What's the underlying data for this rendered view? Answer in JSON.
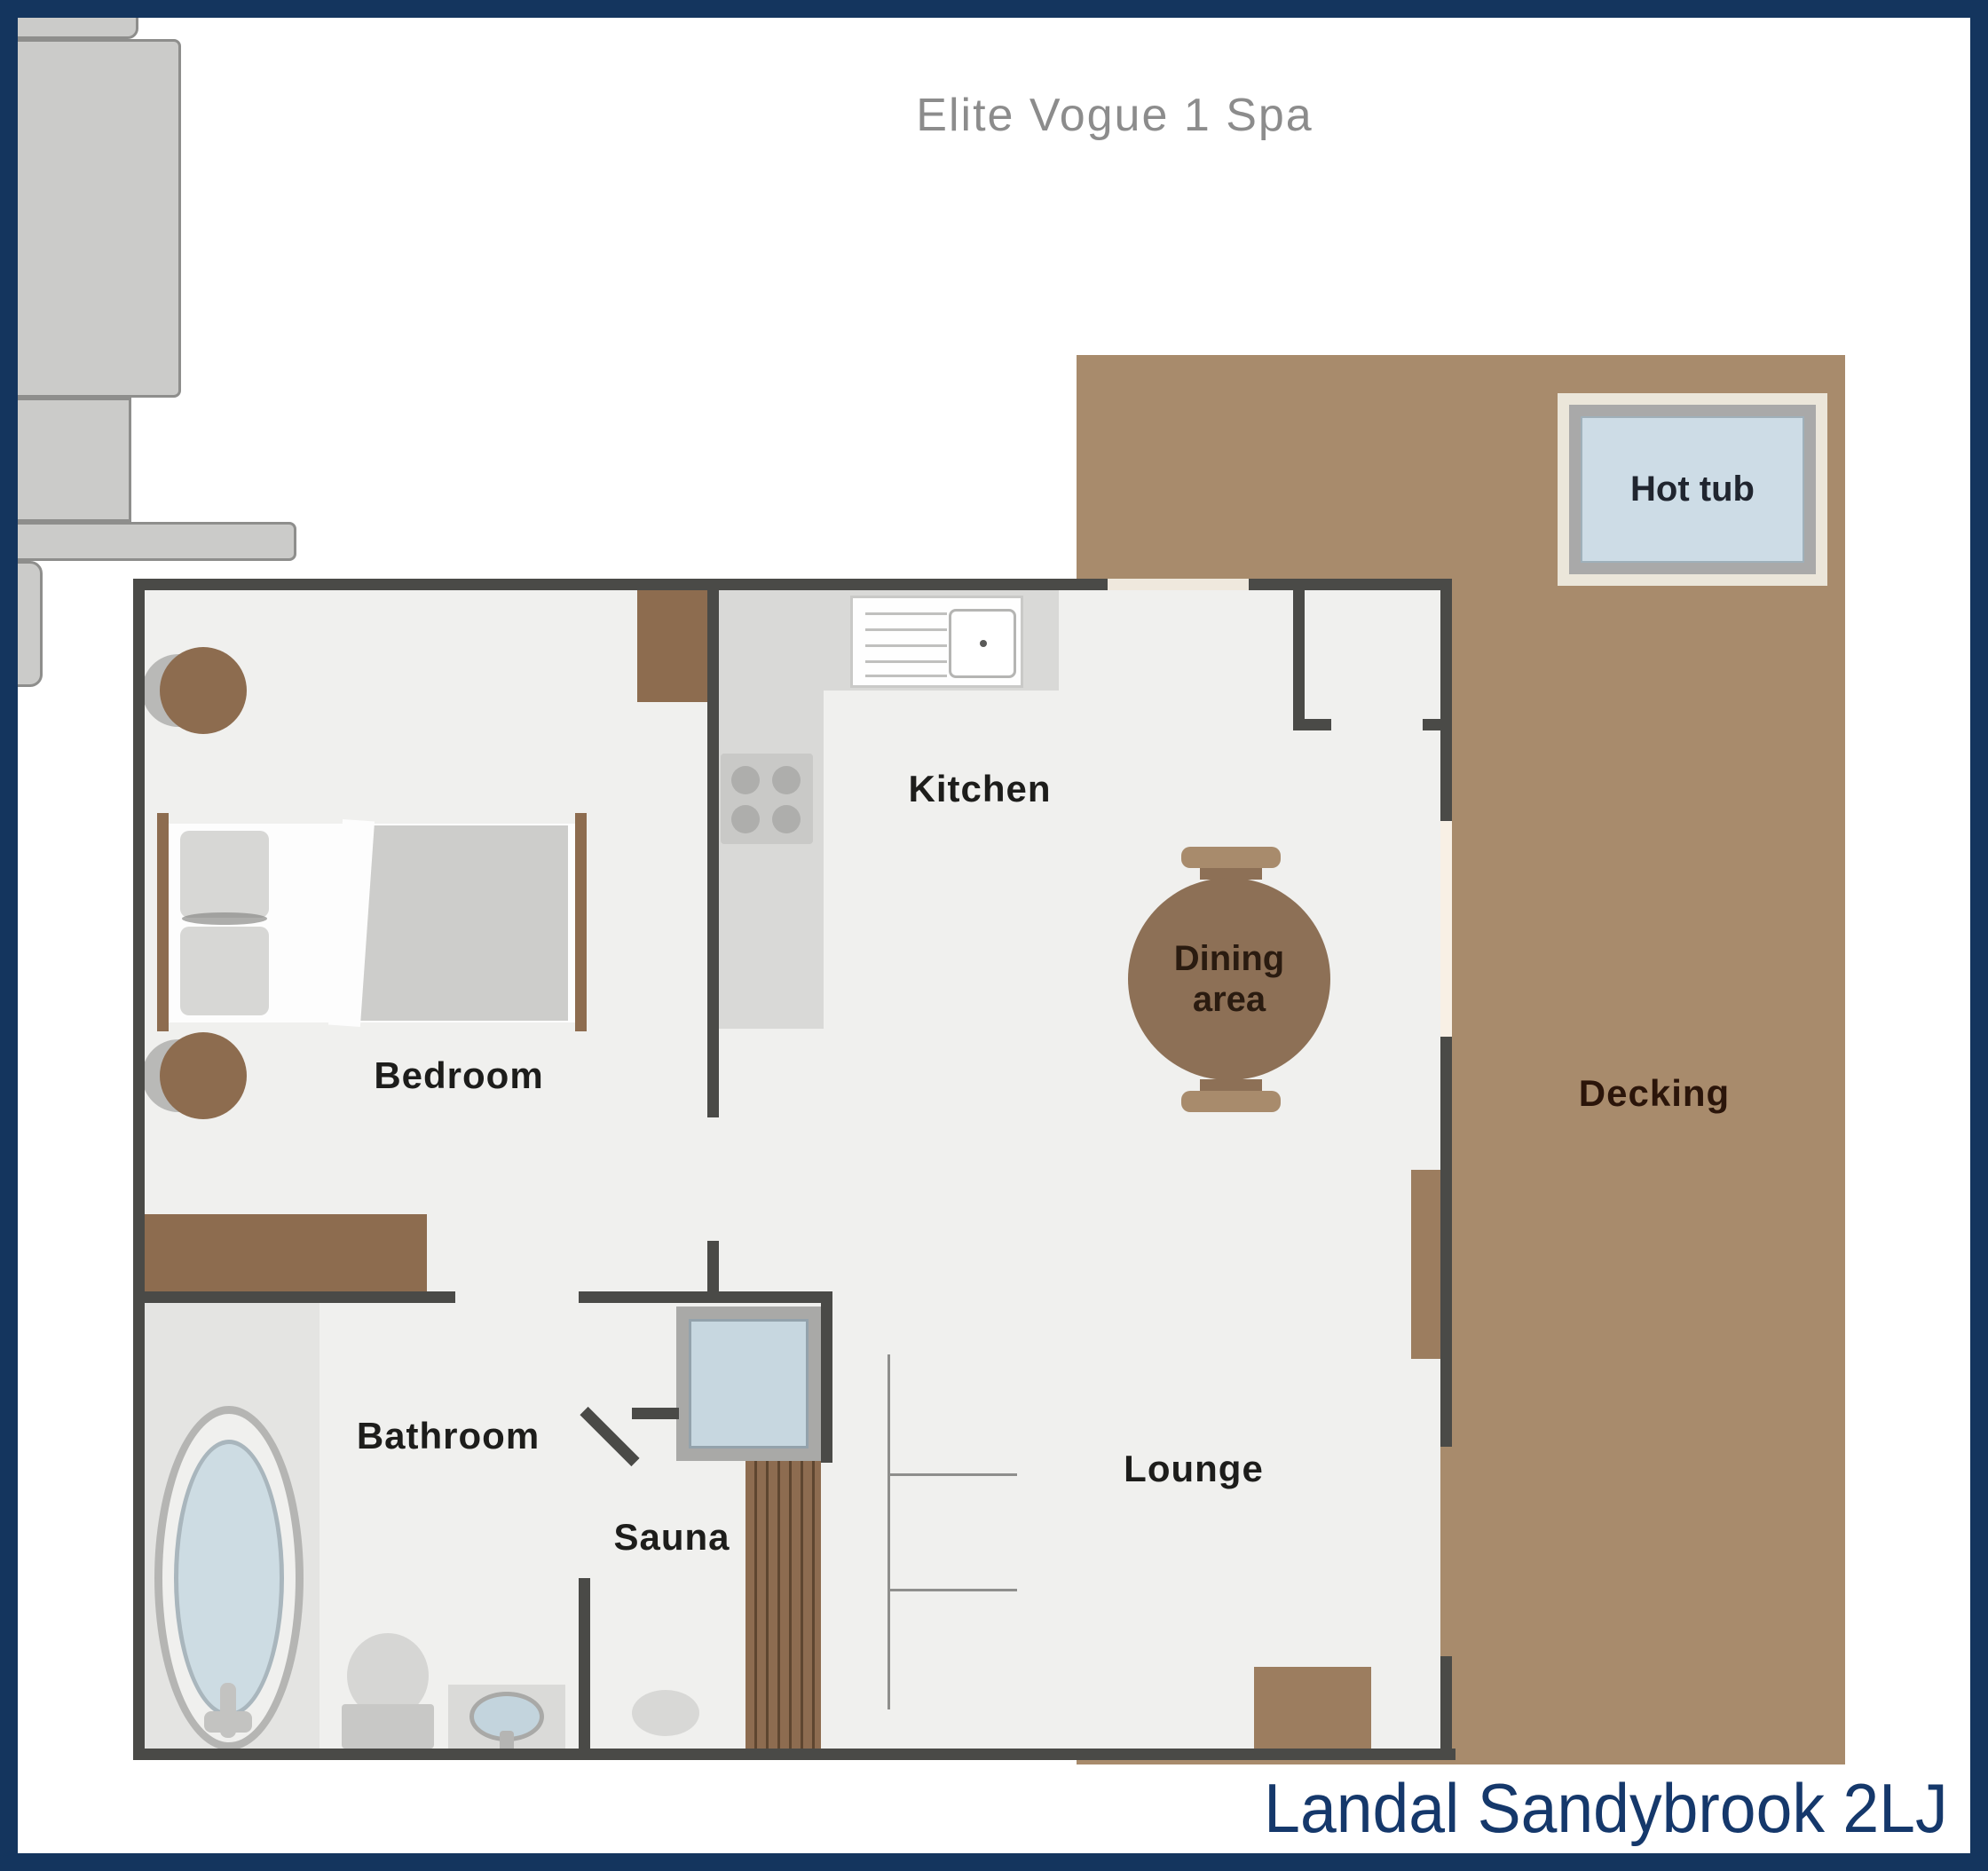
{
  "page": {
    "title": "Elite Vogue 1 Spa",
    "footer": "Landal Sandybrook 2LJ"
  },
  "rooms": {
    "bedroom": "Bedroom",
    "kitchen": "Kitchen",
    "dining": {
      "line1": "Dining",
      "line2": "area"
    },
    "lounge": "Lounge",
    "bathroom": "Bathroom",
    "sauna": "Sauna",
    "decking": "Decking",
    "hot_tub": "Hot tub"
  },
  "colors": {
    "border_navy": "#14355e",
    "footer_text": "#15386b",
    "title_gray": "#8c8c8c",
    "wall": "#4a4a47",
    "floor": "#f0f0ee",
    "decking_brown": "#a88b6c",
    "furniture_brown": "#8d6c4f",
    "table_brown": "#8d7056",
    "water_blue": "#cddce6",
    "sofa_gray": "#cbcbc9"
  }
}
